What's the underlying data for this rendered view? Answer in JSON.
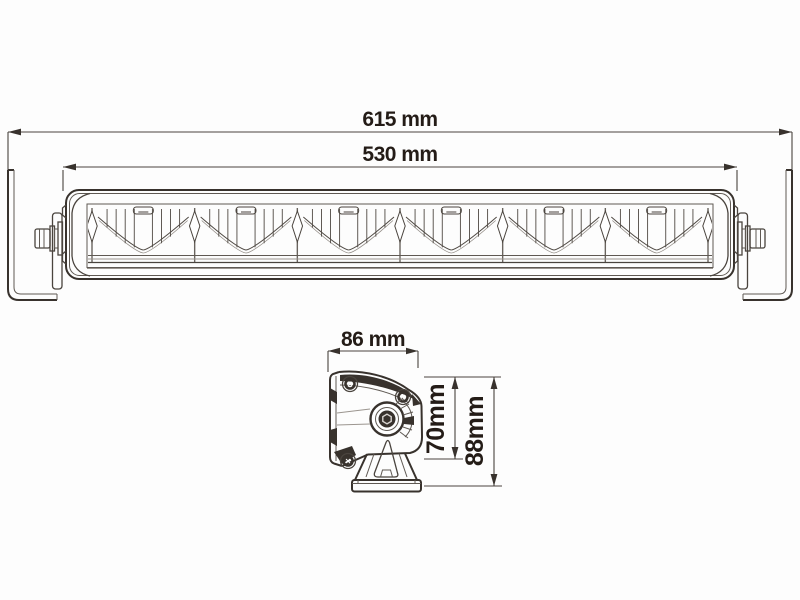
{
  "drawing": {
    "front_view": {
      "dim_overall": {
        "label": "615 mm"
      },
      "dim_body": {
        "label": "530 mm"
      }
    },
    "side_view": {
      "dim_width": {
        "label": "86 mm"
      },
      "dim_height_body": {
        "label": "70mm"
      },
      "dim_height_overall": {
        "label": "88mm"
      }
    }
  },
  "colors": {
    "background": "#fdfdfd",
    "line_dark": "#38322d",
    "line_medium": "#4a443e",
    "line_light": "#9b958f",
    "text": "#241c17"
  }
}
